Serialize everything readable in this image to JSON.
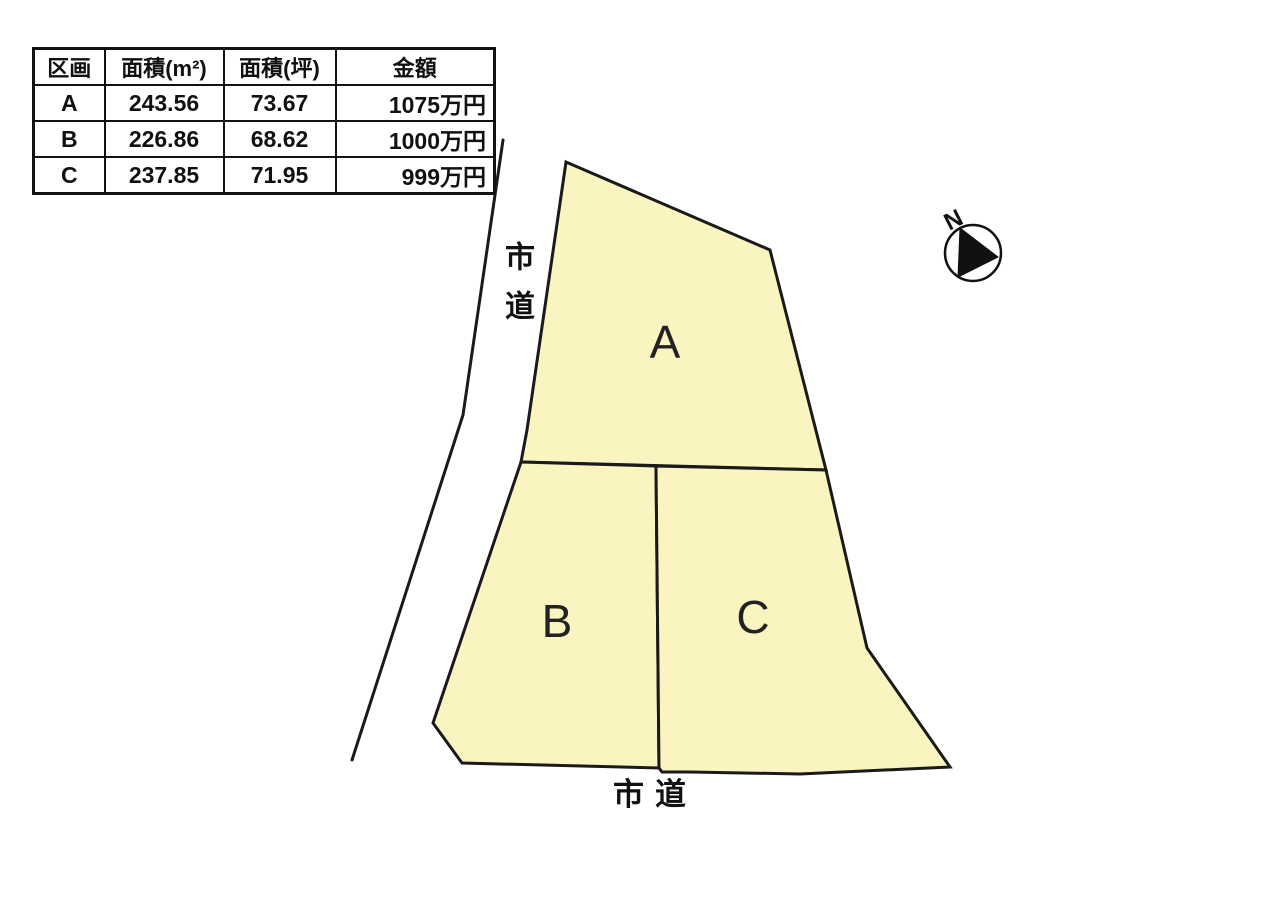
{
  "table": {
    "headers": [
      "区画",
      "面積(m²)",
      "面積(坪)",
      "金額"
    ],
    "rows": [
      {
        "plot": "A",
        "area_m2": "243.56",
        "area_tsubo": "73.67",
        "price": "1075万円"
      },
      {
        "plot": "B",
        "area_m2": "226.86",
        "area_tsubo": "68.62",
        "price": "1000万円"
      },
      {
        "plot": "C",
        "area_m2": "237.85",
        "area_tsubo": "71.95",
        "price": "999万円"
      }
    ]
  },
  "plan": {
    "parcel_fill": "#FAF5C0",
    "line_color": "#1a1a1a",
    "parcels": [
      {
        "label": "A",
        "points": "566,162 770,250 826,470 521,462 527,430"
      },
      {
        "label": "B",
        "points": "521,462 656,466 659,768 462,763 433,723"
      },
      {
        "label": "C",
        "points": "656,466 826,470 867,648 950,767 800,774 690,772 662,772 659,768"
      }
    ],
    "road_edge_points": "503,140 463,415 352,760",
    "road_label_left": "市道",
    "road_label_bottom": "市道"
  },
  "compass": {
    "label": "N"
  }
}
